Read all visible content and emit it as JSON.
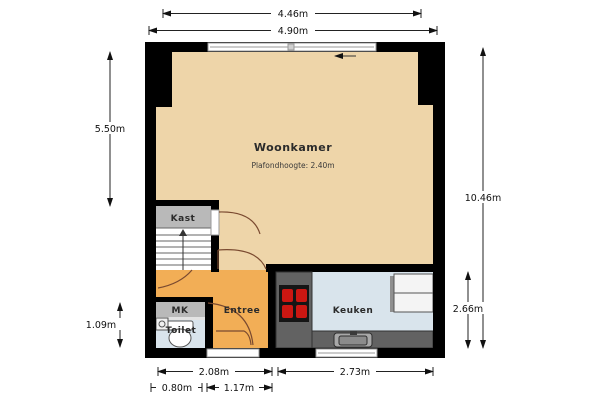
{
  "plan_title": "floor-plan",
  "rooms": {
    "woonkamer": {
      "label": "Woonkamer",
      "ceiling_note": "Plafondhoogte: 2.40m"
    },
    "kast": {
      "label": "Kast"
    },
    "mk": {
      "label": "MK"
    },
    "toilet": {
      "label": "Toilet"
    },
    "entree": {
      "label": "Entree"
    },
    "keuken": {
      "label": "Keuken"
    }
  },
  "dimensions": {
    "top_inner_width": "4.46m",
    "top_outer_width": "4.90m",
    "left_living_height": "5.50m",
    "left_toilet_height": "1.09m",
    "right_total_height": "10.46m",
    "right_kitchen_height": "2.66m",
    "bottom_hall_width": "2.08m",
    "bottom_kitchen_width": "2.73m",
    "bottom_door_width": "0.80m",
    "bottom_entree_width": "1.17m"
  },
  "colors": {
    "wall": "#000000",
    "floor_woonkamer": "#eed5a9",
    "floor_entree": "#f2ae56",
    "floor_keuken": "#d9e4ec",
    "floor_toilet": "#d9e4ec",
    "floor_kast": "#b9b9b9",
    "floor_mk": "#b9b9b9",
    "counter": "#626262",
    "cooktop": "#151515",
    "burner": "#cc1712",
    "appliance": "#f4f4f4",
    "door_arc": "#7a4a30"
  }
}
